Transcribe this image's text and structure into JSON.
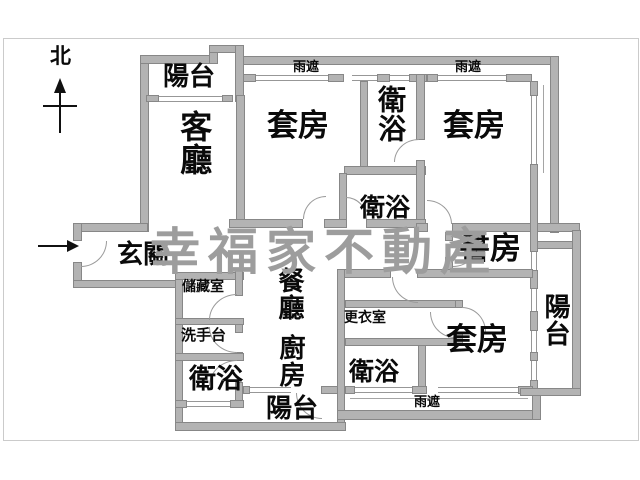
{
  "compass": {
    "north_label": "北"
  },
  "watermark": "幸福家不動產",
  "rooms": {
    "balcony_top": "陽台",
    "living_room": "客廳",
    "suite_top_left": "套房",
    "bath_top": "衛浴",
    "suite_top_right": "套房",
    "bath_mid": "衛浴",
    "entrance": "玄關",
    "study": "書房",
    "dining": "餐廳",
    "kitchen": "廚房",
    "storage": "儲藏室",
    "sink": "洗手台",
    "bath_left": "衛浴",
    "balcony_bottom": "陽台",
    "dressing": "更衣室",
    "bath_bottom": "衛浴",
    "suite_bottom_right": "套房",
    "balcony_right": "陽台"
  },
  "canopies": {
    "top_left": "雨遮",
    "top_right": "雨遮",
    "bottom": "雨遮"
  },
  "colors": {
    "wall_fill": "#b3b3b3",
    "wall_edge": "#878787",
    "watermark_gray": "#9d9d9d",
    "frame_gray": "#cbcbcb",
    "label_black": "#0a0a0a"
  }
}
